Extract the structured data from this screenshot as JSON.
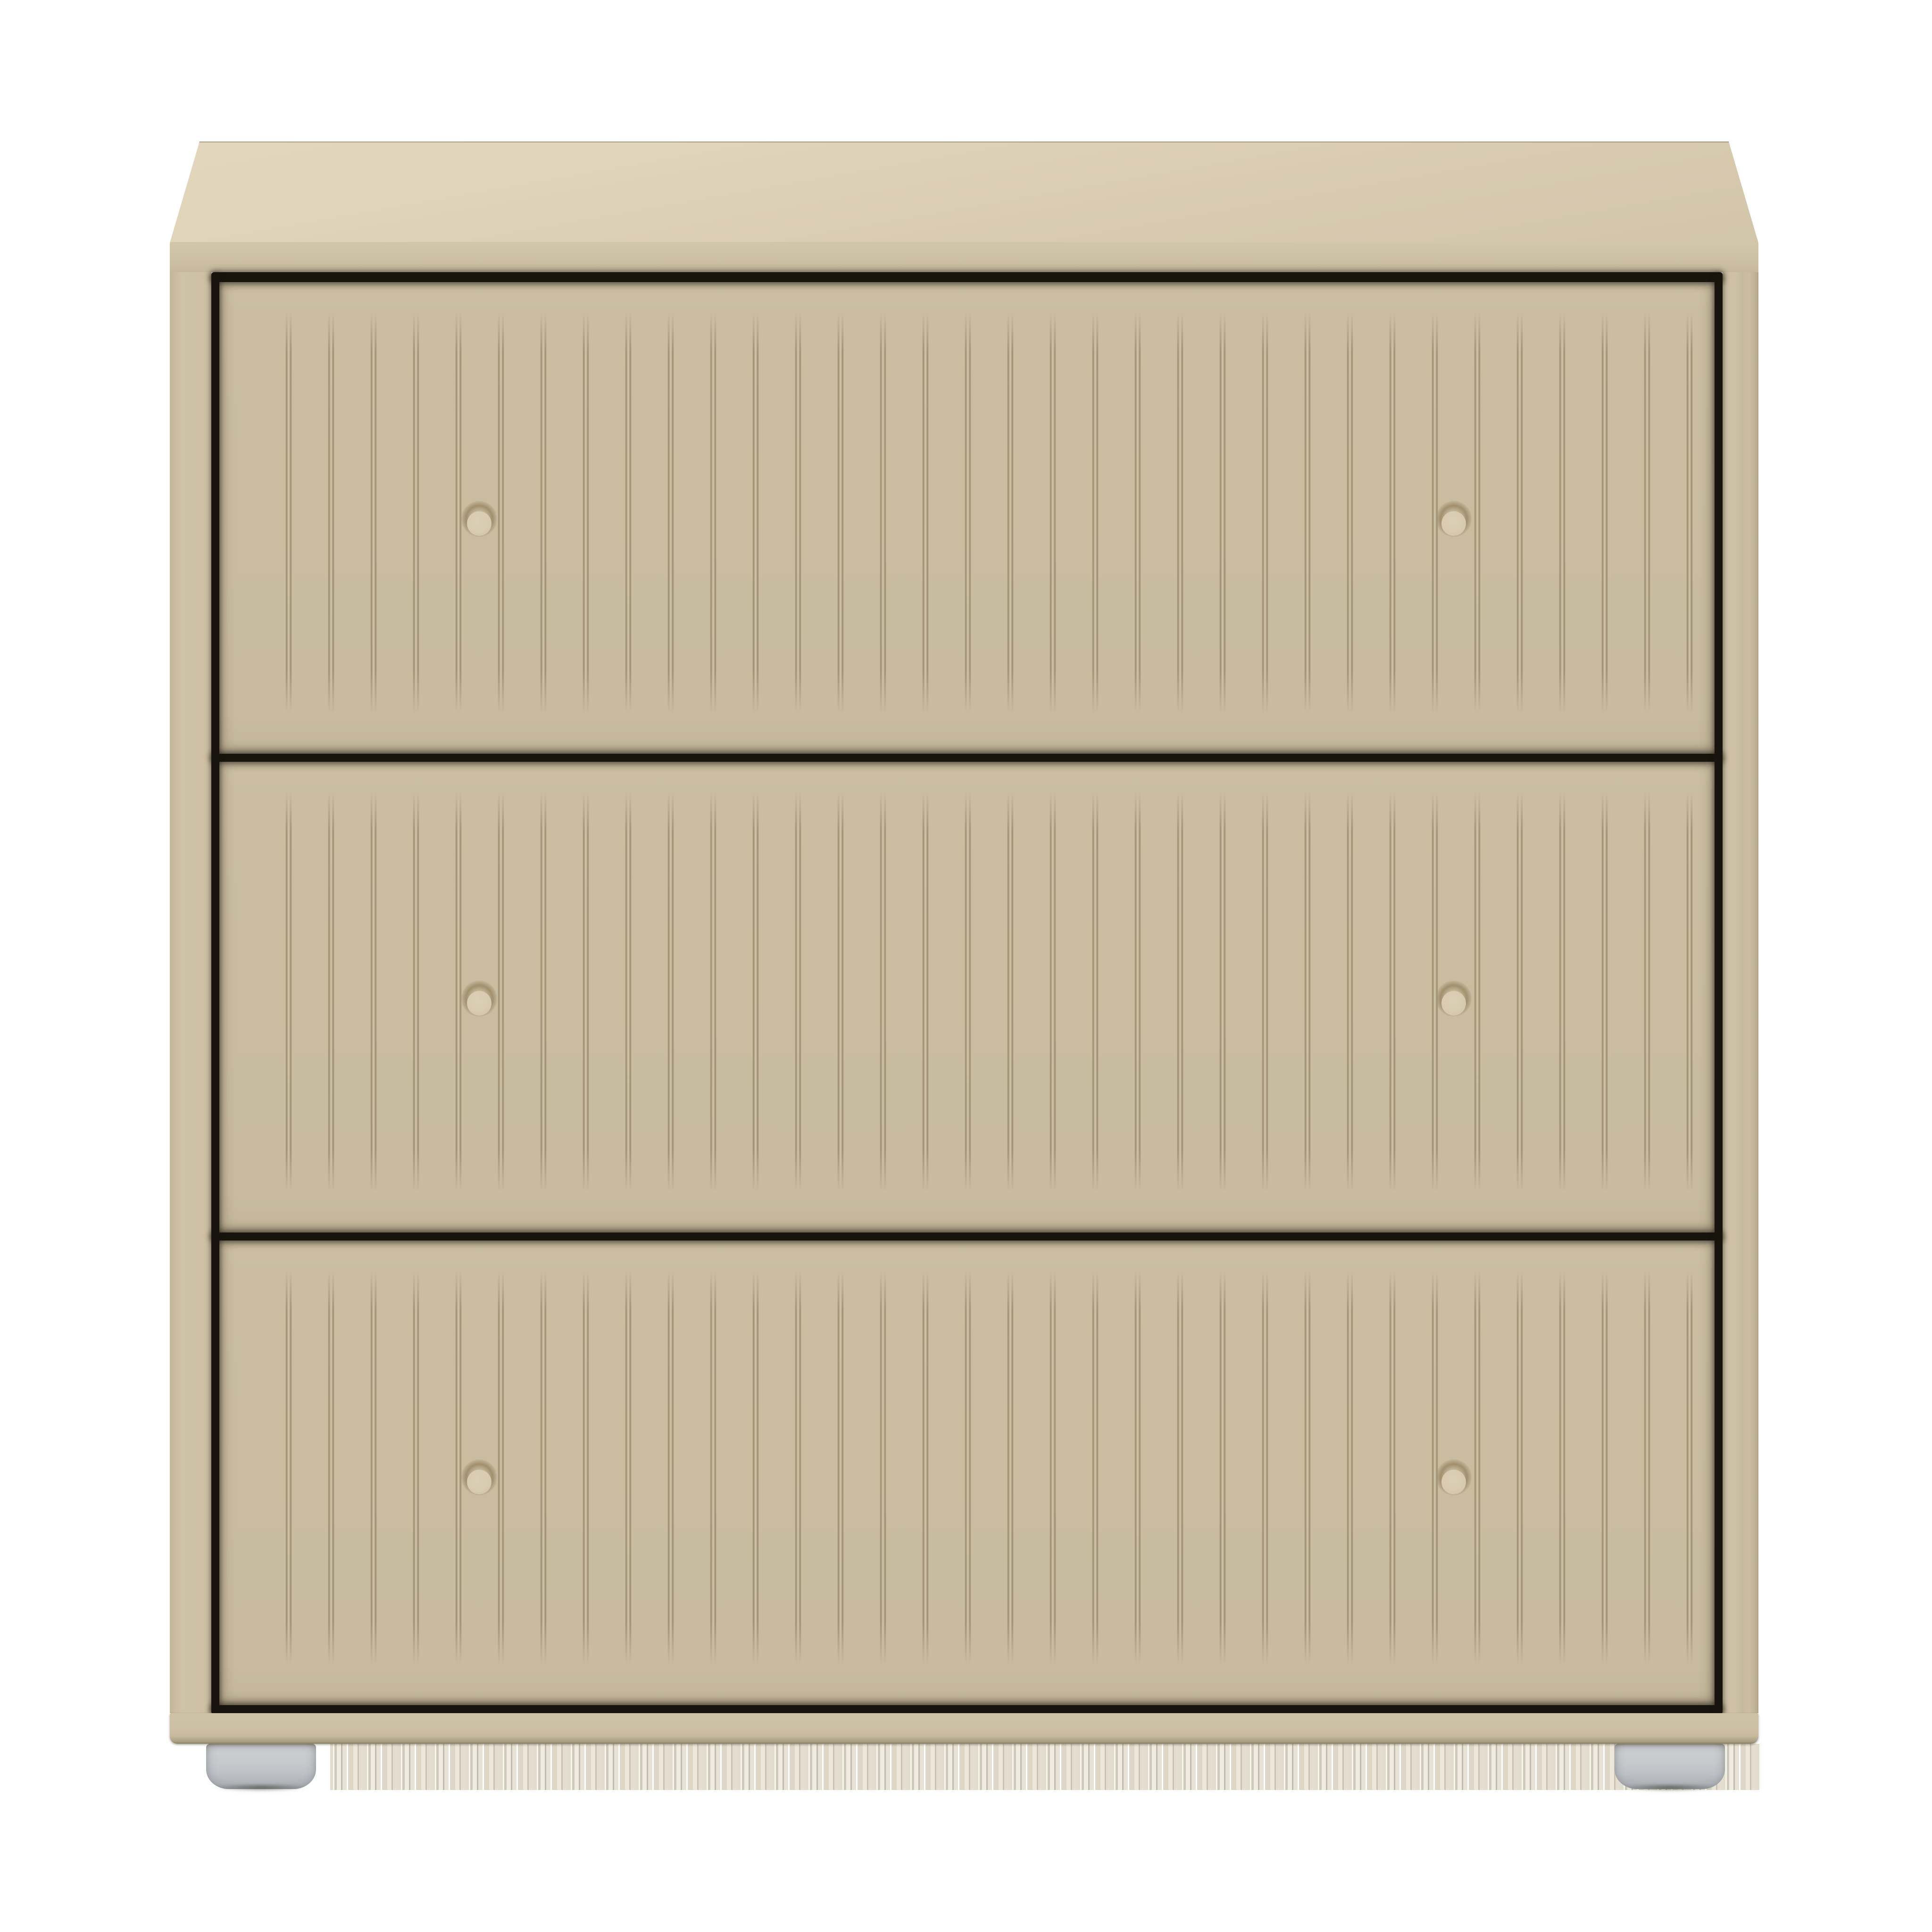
{
  "image": {
    "description": "Product render of a beige three-drawer chest of drawers with vertically fluted drawer fronts, two round wooden knobs per drawer, a plain top and base rail, standing on two visible grey cylindrical feet against a white background"
  },
  "product": {
    "drawer_count": 3,
    "grooves_per_drawer": 34,
    "knobs_per_drawer": 2,
    "feet_count": 2
  },
  "colors": {
    "background": "#ffffff",
    "top_face_light": "#e0d4ba",
    "top_face": "#d8cbb1",
    "top_edge_band": "#ccbfa2",
    "side_stile": "#cdc0a4",
    "drawer_face": "#cabda0",
    "drawer_face_dark": "#c3b699",
    "groove_dark": "#97886a",
    "groove_light": "#d6c9ad",
    "gap_black": "#17130d",
    "knob_face": "#d8cbb0",
    "knob_shadow": "#a18f6d",
    "base_rail": "#ccbfa3",
    "base_rail_dark": "#ab9f84",
    "foot_light": "#cdd1d4",
    "foot": "#c0c4c8",
    "foot_dark": "#a2a6aa"
  }
}
